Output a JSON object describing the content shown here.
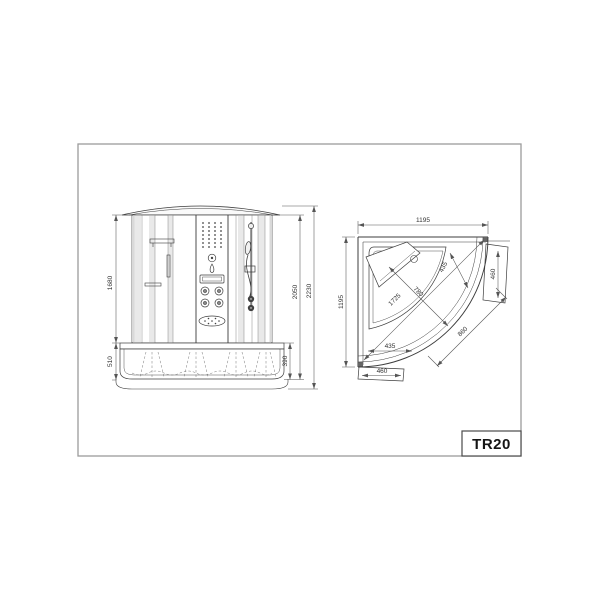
{
  "model": {
    "code": "TR20"
  },
  "colors": {
    "drawing_line": "#3d3d3d",
    "dim_line": "#555555",
    "frame_border": "#9c9c9c",
    "glass_shade": "#e9e9e9"
  },
  "front_view": {
    "dims": {
      "glass_height": "1680",
      "base_height": "510",
      "cabin_height": "2050",
      "total_height": "2230",
      "tub_depth": "390"
    }
  },
  "plan_view": {
    "dims": {
      "width": "1195",
      "depth": "1195",
      "diagonal": "1725",
      "basin_diagonal": "780",
      "corner_detail": "435",
      "side_panel": "460",
      "front_width": "860",
      "basin_width": "435",
      "bottom_panel": "460"
    }
  }
}
